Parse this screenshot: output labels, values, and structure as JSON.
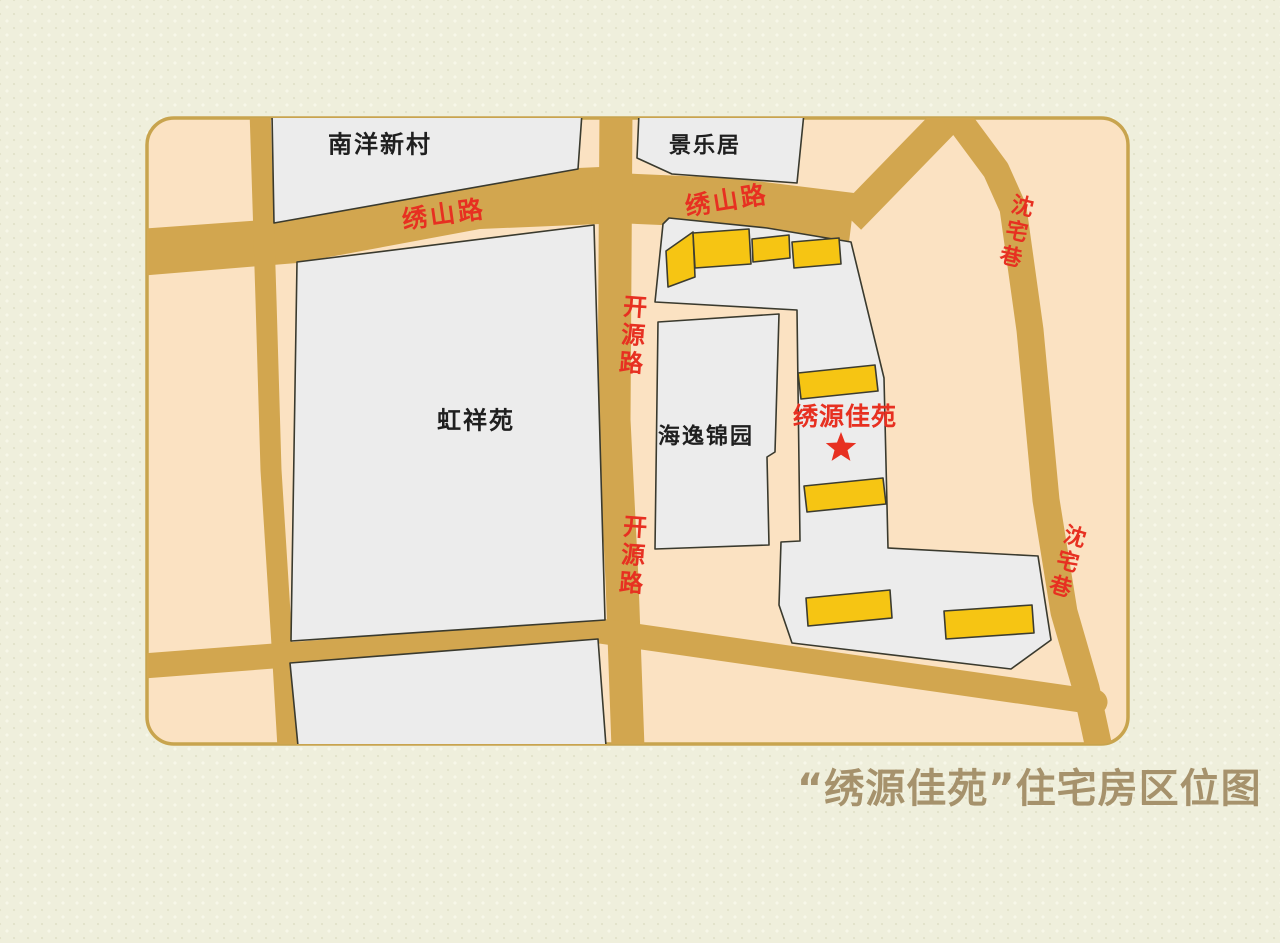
{
  "title": {
    "text": "“绣源佳苑”住宅房区位图",
    "color": "#a6926c"
  },
  "colors": {
    "page_background": "#efefdc",
    "map_fill": "#fbe2c2",
    "map_border": "#c8a44e",
    "road": "#d2a64f",
    "block_fill": "#ececec",
    "block_stroke": "#3a3a2e",
    "building_fill": "#f6c513",
    "building_stroke": "#3c3c30",
    "road_label_red": "#e73021",
    "area_label_black": "#1f1f1f",
    "star_red": "#e73021"
  },
  "areas": {
    "nanyangxincun": "南洋新村",
    "jinglejv": "景乐居",
    "hongxiangyuan": "虹祥苑",
    "haiyijinyuan": "海逸锦园"
  },
  "roads": {
    "xiushan_west": "绣山路",
    "xiushan_east": "绣山路",
    "kaiyuan_upper": "开源路",
    "kaiyuan_lower": "开源路",
    "shenzhai_upper": "沈宅巷",
    "shenzhai_lower": "沈宅巷"
  },
  "landmark": {
    "label": "绣源佳苑",
    "marker": "star-icon"
  }
}
